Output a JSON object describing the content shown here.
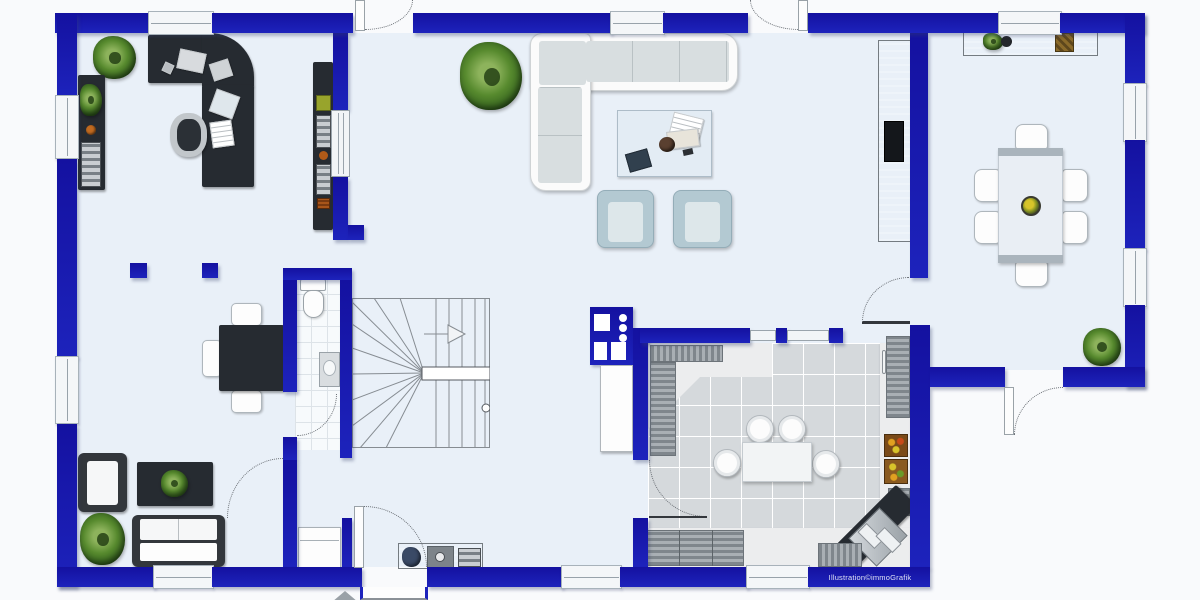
{
  "watermark": "Illustration©immoGrafik",
  "palette": {
    "wall_blue": "#1d23bc",
    "floor": "#e9f0f8",
    "outside": "#f9fafc",
    "dark_furniture": "#262b31",
    "gray_furniture": "#9aa1a7",
    "kitchen_tile": "#d5d9dc",
    "armchair_blue": "#b3c9d2",
    "plant_green": "#578a2e",
    "window_frame": "#f4f6f8"
  },
  "elements": {
    "office": [
      "corner-desk",
      "office-chair",
      "papers",
      "laptop",
      "potted-plant",
      "sideboard",
      "wall-shelf"
    ],
    "living_room": [
      "l-shaped-sofa",
      "coffee-table",
      "armchair",
      "armchair",
      "potted-plant"
    ],
    "dining_room": [
      "dining-table",
      "six-chairs",
      "fruit-bowl",
      "sideboard",
      "tv-unit"
    ],
    "kitchen": [
      "corner-counter",
      "island-with-stools",
      "fridge",
      "fruit-crates",
      "corner-sink",
      "base-cabinets"
    ],
    "lounge": [
      "armchair",
      "coffee-table-with-plant",
      "sofa",
      "potted-plant"
    ],
    "hall": [
      "meeting-table",
      "chairs",
      "sideboard-with-appliances",
      "staircase",
      "utility-unit",
      "wc-toilet",
      "wc-sink"
    ],
    "doors": [
      "front-door",
      "terrace-door-left",
      "terrace-door-right",
      "back-door",
      "kitchen-door",
      "dining-door",
      "wc-door",
      "lounge-door"
    ],
    "stools_at_island": 4,
    "dining_chairs": 6
  }
}
